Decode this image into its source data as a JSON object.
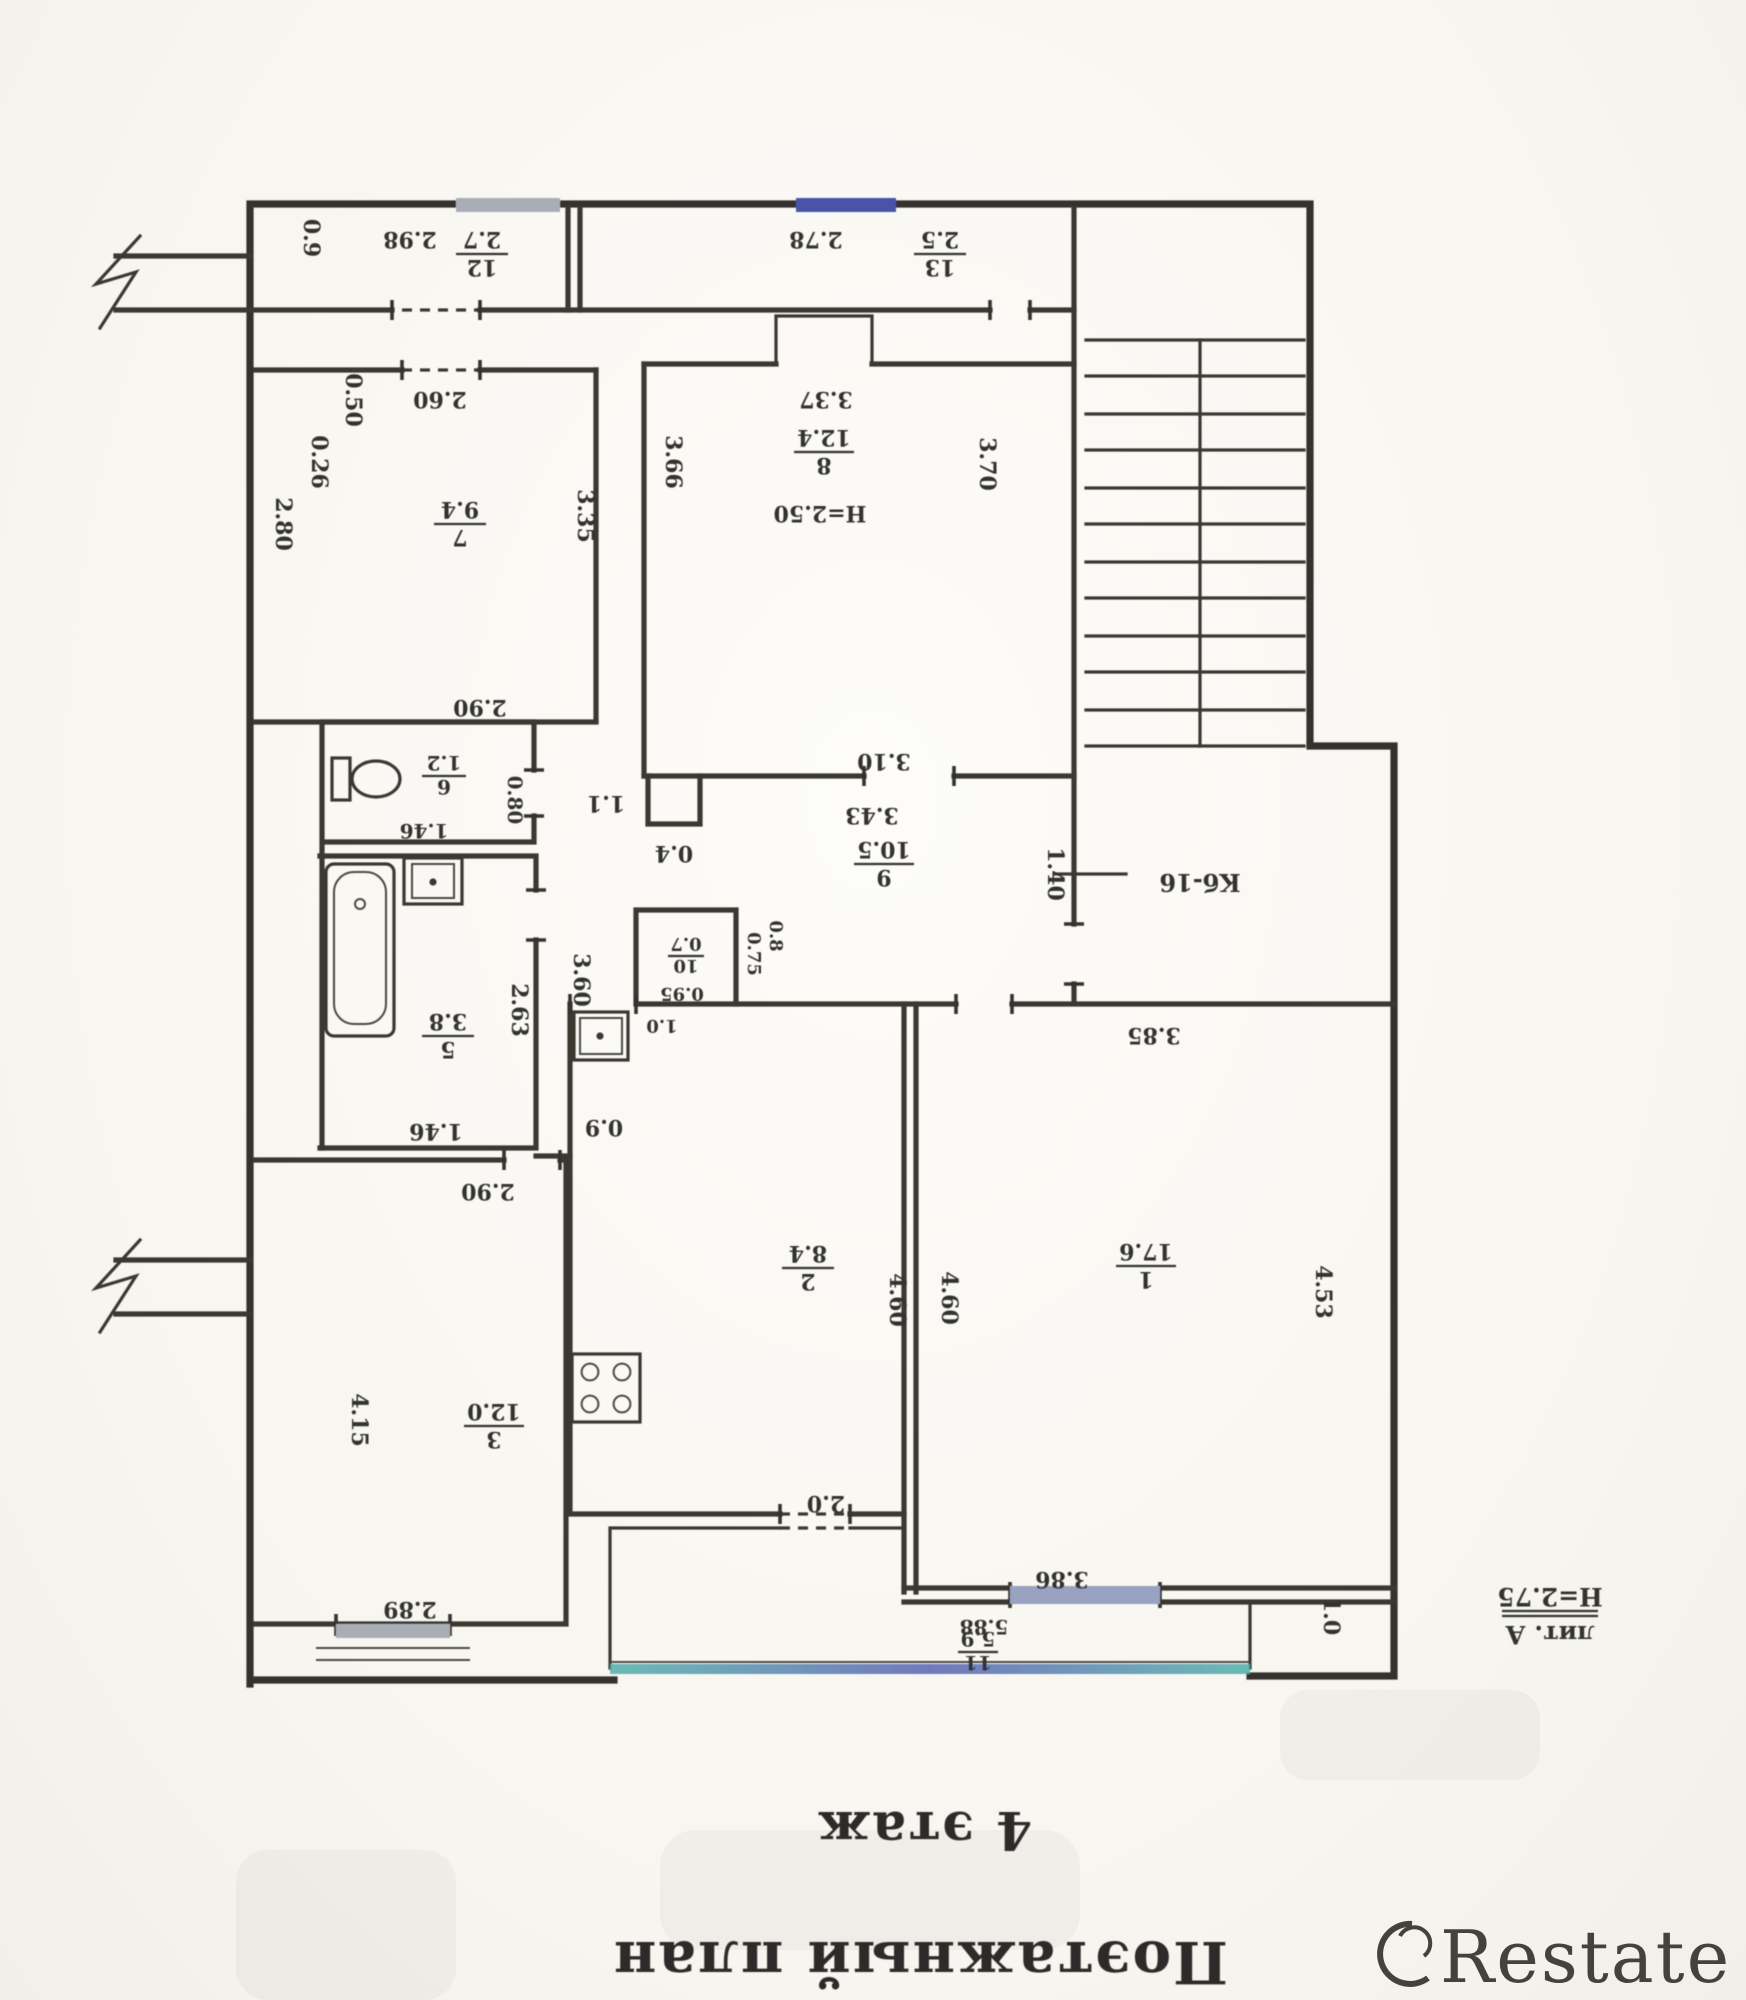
{
  "titles": {
    "floor": "4 этаж",
    "plan": "Поэтажный план",
    "litera": "лит. А",
    "litera_height": "Н=2.75",
    "stair_mark": "Кб-16"
  },
  "rooms": {
    "r1": {
      "num": "1",
      "area": "17.6"
    },
    "r2": {
      "num": "2",
      "area": "8.4"
    },
    "r3": {
      "num": "3",
      "area": "12.0"
    },
    "r5": {
      "num": "5",
      "area": "3.8"
    },
    "r6": {
      "num": "6",
      "area": "1.2"
    },
    "r7": {
      "num": "7",
      "area": "9.4"
    },
    "r8": {
      "num": "8",
      "area": "12.4",
      "height": "Н=2.50"
    },
    "r9": {
      "num": "9",
      "area": "10.5"
    },
    "r10": {
      "num": "10",
      "area": "0.7"
    },
    "r11": {
      "num": "11",
      "area": "5.9"
    },
    "r12": {
      "num": "12",
      "area": "2.7"
    },
    "r13": {
      "num": "13",
      "area": "2.5"
    }
  },
  "dims": {
    "d09a": "0.9",
    "d298": "2.98",
    "d278": "2.78",
    "d260": "2.60",
    "d050": "0.50",
    "d026": "0.26",
    "d280": "2.80",
    "d335": "3.35",
    "d290a": "2.90",
    "d337": "3.37",
    "d366": "3.66",
    "d370": "3.70",
    "d310": "3.10",
    "d343": "3.43",
    "d140": "1.40",
    "d146a": "1.46",
    "d080": "0.80",
    "d11": "1.1",
    "d04": "0.4",
    "d263": "2.63",
    "d360": "3.60",
    "d146b": "1.46",
    "d09b": "0.9",
    "d290b": "2.90",
    "d415": "4.15",
    "d289": "2.89",
    "d460a": "4.60",
    "d460b": "4.60",
    "d20": "2.0",
    "d075": "0.75",
    "d095": "0.95",
    "d08": "0.8",
    "d10k": "1.0",
    "d385": "3.85",
    "d453": "4.53",
    "d386": "3.86",
    "d588": "5.88",
    "d10": "1.0"
  },
  "colors": {
    "window_dark_blue": "#4a52a8",
    "window_gray": "#a9adb6",
    "window_light": "#99a2c0",
    "railing_teal": "#53b0ac",
    "railing_blue": "#5b63b4",
    "ink": "#34322e"
  },
  "watermark": {
    "brand": "Restate"
  }
}
